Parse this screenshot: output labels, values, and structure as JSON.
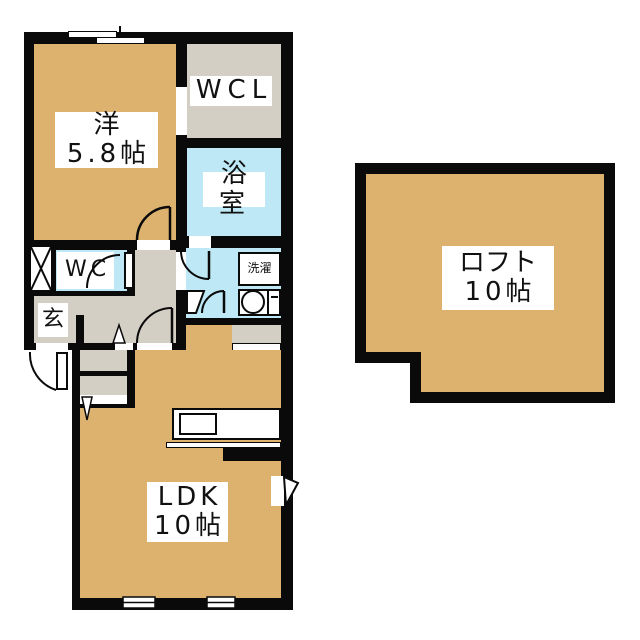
{
  "rooms": {
    "western": {
      "name": "洋",
      "size": "5.8帖"
    },
    "wcl": {
      "name": "WCL"
    },
    "bath": {
      "name": "浴室"
    },
    "wc": {
      "name": "WC"
    },
    "genkan": {
      "name": "玄"
    },
    "laundry": {
      "name": "洗濯"
    },
    "ldk": {
      "name": "LDK",
      "size": "10帖"
    },
    "loft": {
      "name": "ロフト",
      "size": "10帖"
    }
  },
  "colors": {
    "room_tan": "#DDB26E",
    "service_gray": "#D4CFC4",
    "wet_blue": "#BEE8F5",
    "wall_black": "#0A0A0A",
    "background": "#FFFFFF"
  }
}
